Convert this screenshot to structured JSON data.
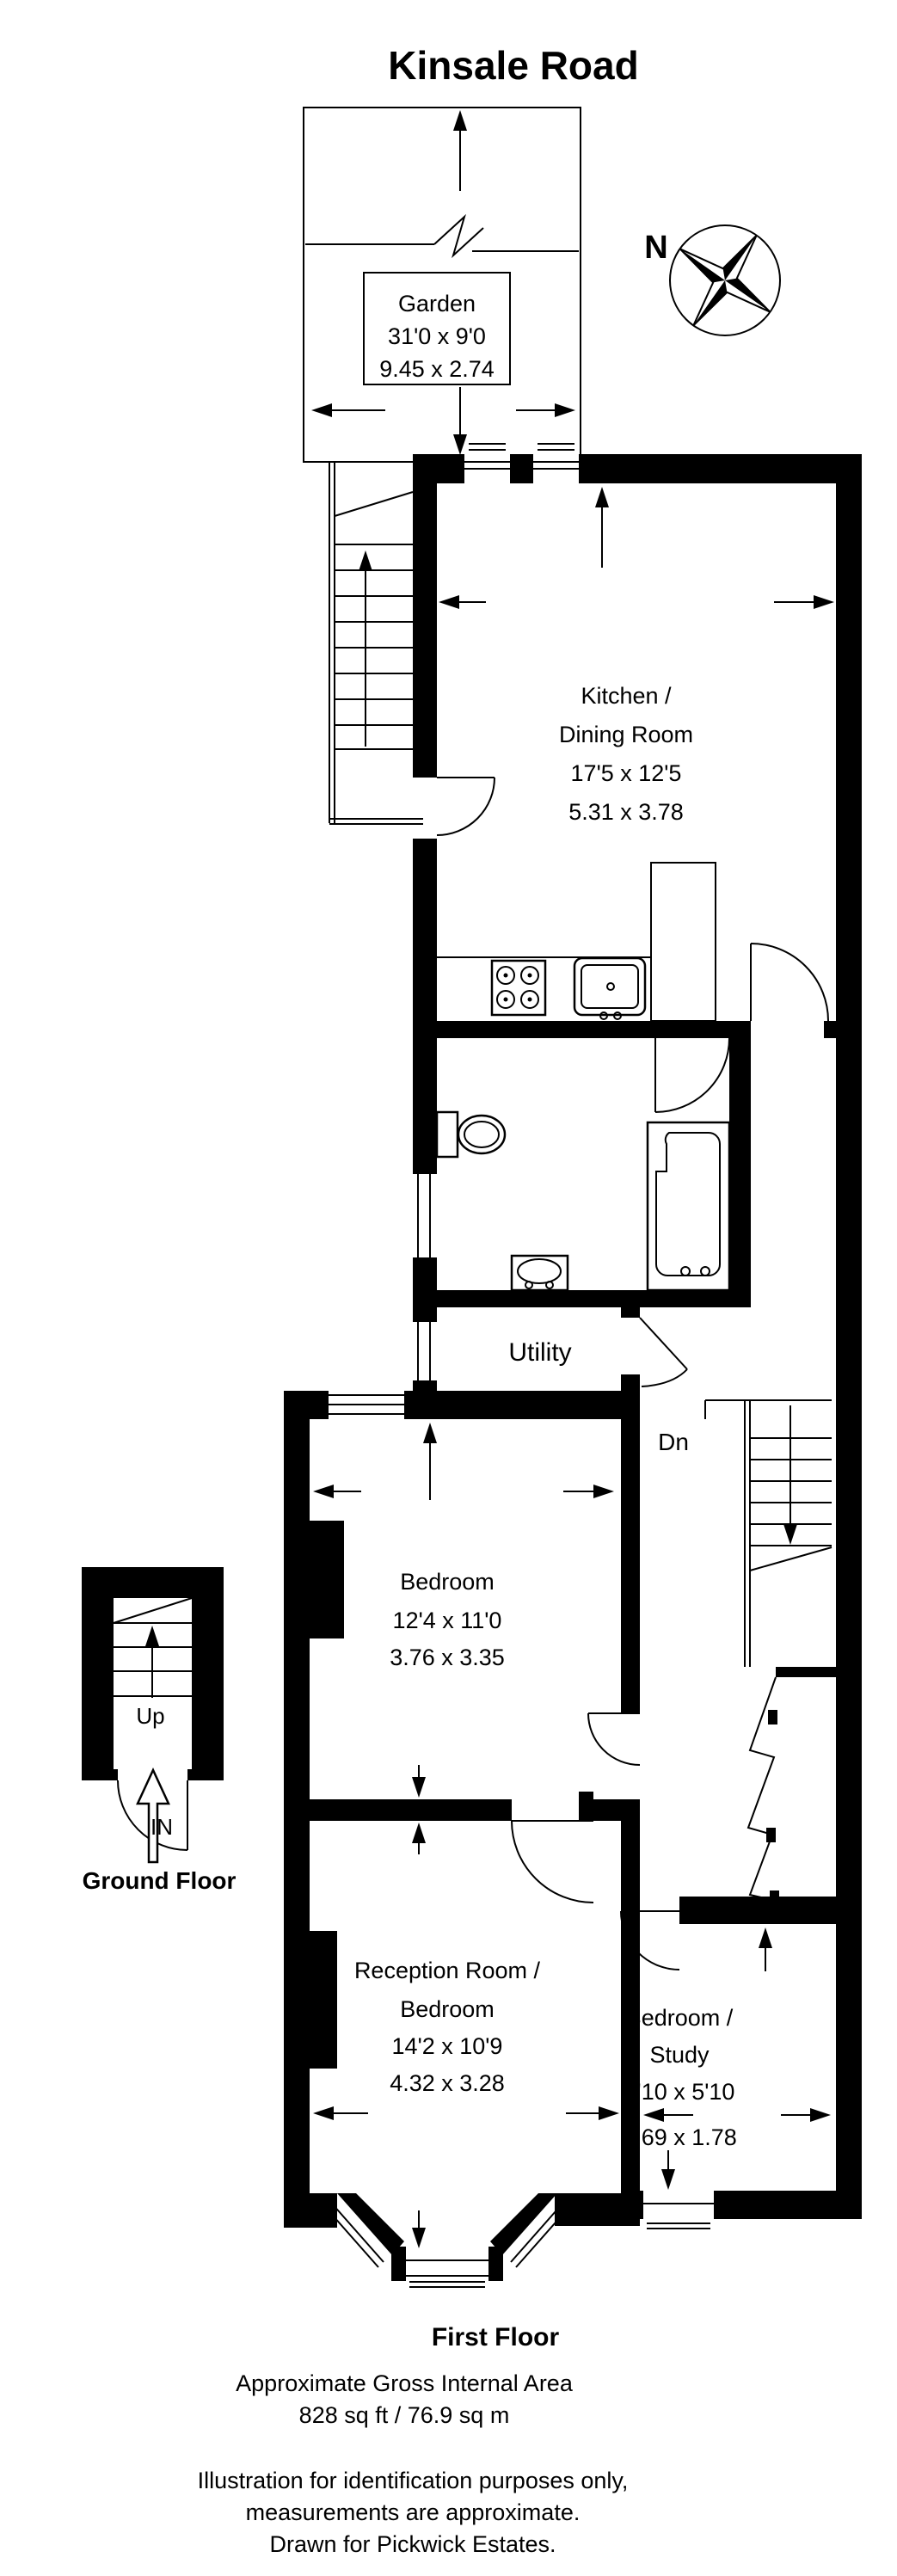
{
  "title": "Kinsale Road",
  "compass_label": "N",
  "labels": {
    "garden": [
      "Garden",
      "31'0 x 9'0",
      "9.45 x 2.74"
    ],
    "kitchen": [
      "Kitchen /",
      "Dining Room",
      "17'5 x 12'5",
      "5.31 x 3.78"
    ],
    "utility": "Utility",
    "bedroom": [
      "Bedroom",
      "12'4 x 11'0",
      "3.76 x 3.35"
    ],
    "reception": [
      "Reception Room /",
      "Bedroom",
      "14'2 x 10'9",
      "4.32 x 3.28"
    ],
    "study": [
      "Bedroom /",
      "Study",
      "8'10 x 5'10",
      "2.69 x 1.78"
    ],
    "stair_dn": "Dn",
    "stair_up": "Up",
    "entrance_in": "IN",
    "ground_floor": "Ground Floor",
    "first_floor": "First Floor"
  },
  "footer": {
    "area_line1": "Approximate Gross Internal Area",
    "area_line2": "828 sq ft / 76.9 sq m",
    "disclaimer1": "Illustration for identification purposes only,",
    "disclaimer2": "measurements are approximate.",
    "disclaimer3": "Drawn for Pickwick Estates."
  },
  "colors": {
    "wall": "#000000",
    "background": "#ffffff"
  }
}
